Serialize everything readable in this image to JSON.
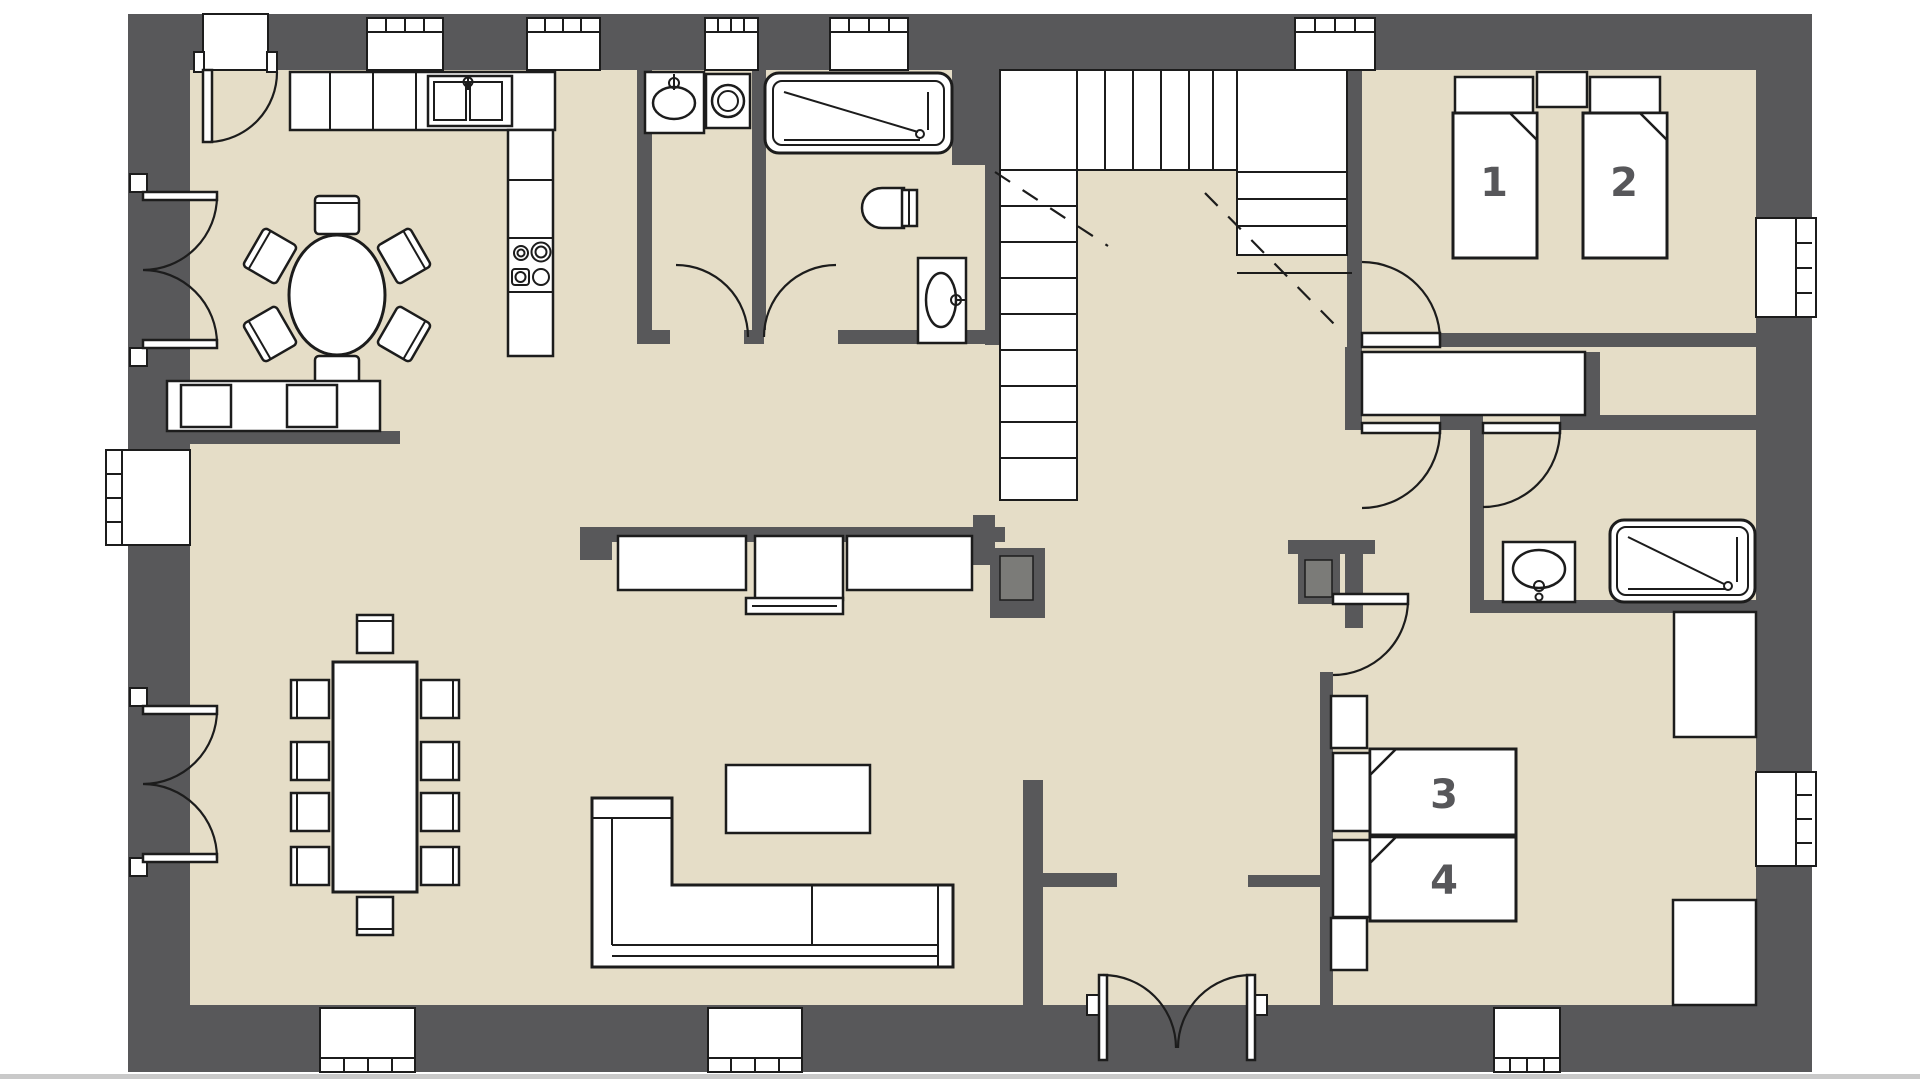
{
  "colors": {
    "wall": "#58585a",
    "floor": "#e5ddc7",
    "line": "#1c1c1c",
    "fixture_fill": "#ffffff",
    "label": "#57575a",
    "chimney_inner": "#7b7b78",
    "bottom_strip": "#c9c9c9",
    "background": "#ffffff"
  },
  "floor_plan": {
    "bed_labels": {
      "bed_1": "1",
      "bed_2": "2",
      "bed_3": "3",
      "bed_4": "4"
    },
    "fixture_names": [
      "entrance-door-top",
      "entrance-double-door-bottom",
      "french-door-upper-left",
      "french-door-lower-left",
      "kitchen-counter",
      "kitchen-sink",
      "stove",
      "laundry-sink",
      "washing-machine",
      "bathtub",
      "toilet",
      "washbasin",
      "staircase",
      "hall-closet",
      "shower",
      "bathroom-sink",
      "bed-1",
      "bed-2",
      "bed-3",
      "bed-4",
      "nightstands",
      "wardrobes",
      "round-dining-table",
      "dining-chairs",
      "long-dining-table",
      "bench-with-cushions",
      "corner-sofa",
      "coffee-table",
      "sideboard",
      "windows",
      "chimney"
    ]
  }
}
